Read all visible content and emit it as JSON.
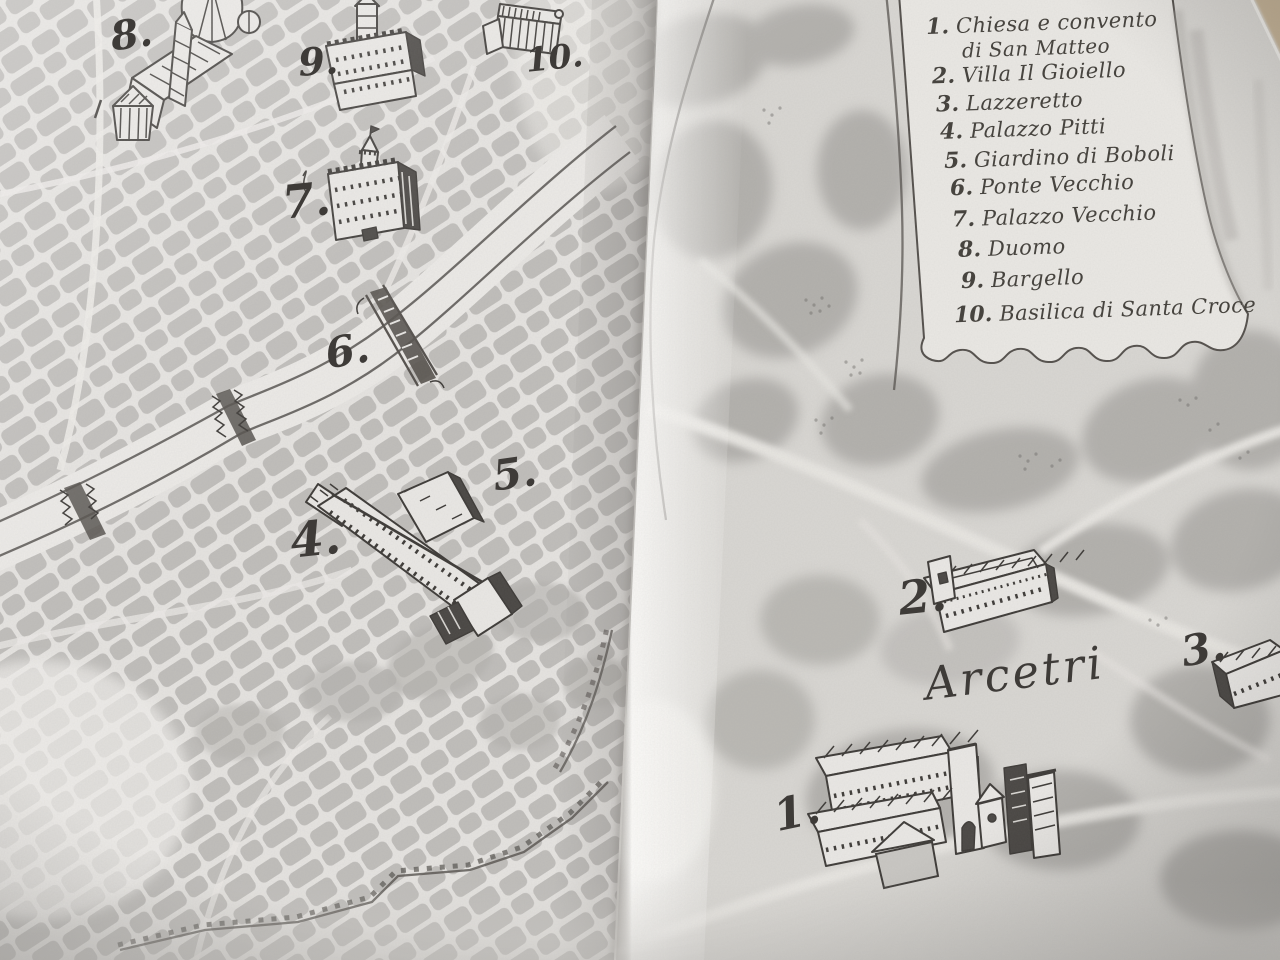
{
  "colors": {
    "ink": "#3e3b38",
    "paper-left": "#e6e4e1",
    "paper-right": "#d9d7d3",
    "block-gray": "#b6b4b1",
    "field-gray": "#b3b1ad",
    "scroll-paper": "#eae8e4",
    "table-beige": "#c2b094"
  },
  "legend": {
    "items": [
      {
        "num": "1.",
        "text": "Chiesa e convento",
        "text2": "di San Matteo"
      },
      {
        "num": "2.",
        "text": "Villa Il Gioiello"
      },
      {
        "num": "3.",
        "text": "Lazzeretto"
      },
      {
        "num": "4.",
        "text": "Palazzo Pitti"
      },
      {
        "num": "5.",
        "text": "Giardino di Boboli"
      },
      {
        "num": "6.",
        "text": "Ponte Vecchio"
      },
      {
        "num": "7.",
        "text": "Palazzo Vecchio"
      },
      {
        "num": "8.",
        "text": "Duomo"
      },
      {
        "num": "9.",
        "text": "Bargello"
      },
      {
        "num": "10.",
        "text": "Basilica di Santa Croce"
      }
    ]
  },
  "map": {
    "markers": {
      "m1": "1.",
      "m2": "2.",
      "m3": "3.",
      "m4": "4.",
      "m5": "5.",
      "m6": "6.",
      "m7": "7.",
      "m8": "8.",
      "m9": "9.",
      "m10": "10."
    },
    "place_labels": {
      "arcetri": "Arcetri"
    }
  }
}
